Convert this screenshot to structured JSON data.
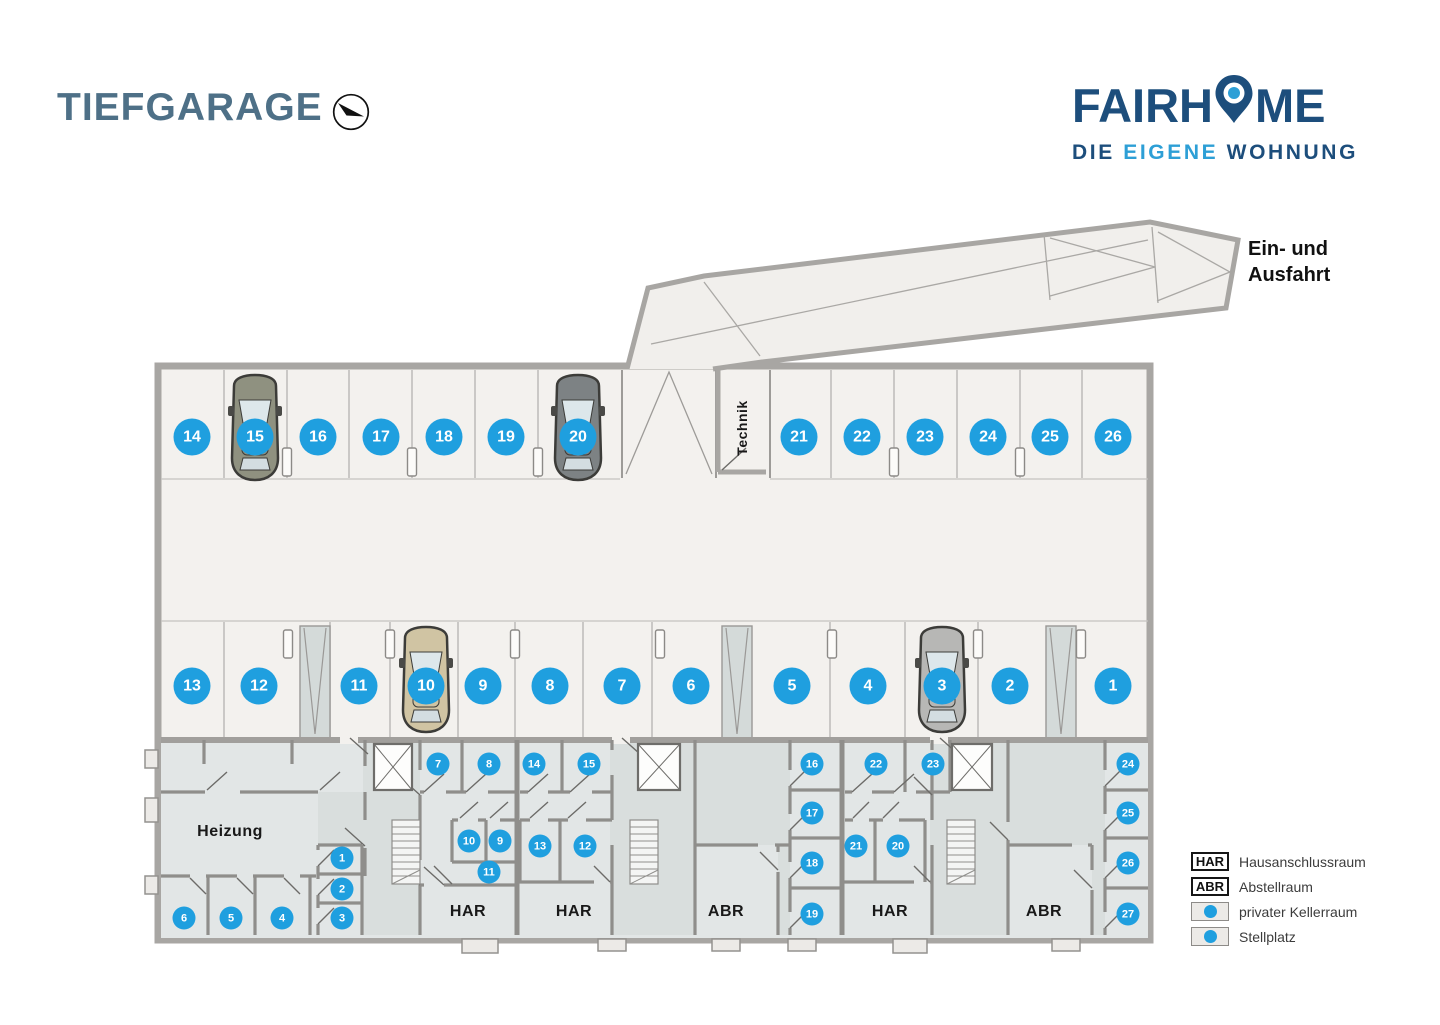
{
  "header": {
    "title": "TIEFGARAGE",
    "logo": {
      "part1": "FAIRH",
      "part2": "ME",
      "tagline_1": "DIE",
      "tagline_2": "EIGENE",
      "tagline_3": "WOHNUNG"
    }
  },
  "plan": {
    "labels": {
      "entrance_line1": "Ein- und",
      "entrance_line2": "Ausfahrt",
      "technik": "Technik",
      "heizung": "Heizung",
      "har": "HAR",
      "abr": "ABR"
    },
    "parking_spots": [
      {
        "n": "14",
        "x": 192,
        "y": 437
      },
      {
        "n": "15",
        "x": 255,
        "y": 437
      },
      {
        "n": "16",
        "x": 318,
        "y": 437
      },
      {
        "n": "17",
        "x": 381,
        "y": 437
      },
      {
        "n": "18",
        "x": 444,
        "y": 437
      },
      {
        "n": "19",
        "x": 506,
        "y": 437
      },
      {
        "n": "20",
        "x": 578,
        "y": 437
      },
      {
        "n": "21",
        "x": 799,
        "y": 437
      },
      {
        "n": "22",
        "x": 862,
        "y": 437
      },
      {
        "n": "23",
        "x": 925,
        "y": 437
      },
      {
        "n": "24",
        "x": 988,
        "y": 437
      },
      {
        "n": "25",
        "x": 1050,
        "y": 437
      },
      {
        "n": "26",
        "x": 1113,
        "y": 437
      },
      {
        "n": "13",
        "x": 192,
        "y": 686
      },
      {
        "n": "12",
        "x": 259,
        "y": 686
      },
      {
        "n": "11",
        "x": 359,
        "y": 686
      },
      {
        "n": "10",
        "x": 426,
        "y": 686
      },
      {
        "n": "9",
        "x": 483,
        "y": 686
      },
      {
        "n": "8",
        "x": 550,
        "y": 686
      },
      {
        "n": "7",
        "x": 622,
        "y": 686
      },
      {
        "n": "6",
        "x": 691,
        "y": 686
      },
      {
        "n": "5",
        "x": 792,
        "y": 686
      },
      {
        "n": "4",
        "x": 868,
        "y": 686
      },
      {
        "n": "3",
        "x": 942,
        "y": 686
      },
      {
        "n": "2",
        "x": 1010,
        "y": 686
      },
      {
        "n": "1",
        "x": 1113,
        "y": 686
      }
    ],
    "cellar_rooms": [
      {
        "n": "1",
        "x": 342,
        "y": 858
      },
      {
        "n": "2",
        "x": 342,
        "y": 889
      },
      {
        "n": "3",
        "x": 342,
        "y": 918
      },
      {
        "n": "4",
        "x": 282,
        "y": 918
      },
      {
        "n": "5",
        "x": 231,
        "y": 918
      },
      {
        "n": "6",
        "x": 184,
        "y": 918
      },
      {
        "n": "7",
        "x": 438,
        "y": 764
      },
      {
        "n": "8",
        "x": 489,
        "y": 764
      },
      {
        "n": "9",
        "x": 500,
        "y": 841
      },
      {
        "n": "10",
        "x": 469,
        "y": 841
      },
      {
        "n": "11",
        "x": 489,
        "y": 872
      },
      {
        "n": "12",
        "x": 585,
        "y": 846
      },
      {
        "n": "13",
        "x": 540,
        "y": 846
      },
      {
        "n": "14",
        "x": 534,
        "y": 764
      },
      {
        "n": "15",
        "x": 589,
        "y": 764
      },
      {
        "n": "16",
        "x": 812,
        "y": 764
      },
      {
        "n": "17",
        "x": 812,
        "y": 813
      },
      {
        "n": "18",
        "x": 812,
        "y": 863
      },
      {
        "n": "19",
        "x": 812,
        "y": 914
      },
      {
        "n": "20",
        "x": 898,
        "y": 846
      },
      {
        "n": "21",
        "x": 856,
        "y": 846
      },
      {
        "n": "22",
        "x": 876,
        "y": 764
      },
      {
        "n": "23",
        "x": 933,
        "y": 764
      },
      {
        "n": "24",
        "x": 1128,
        "y": 764
      },
      {
        "n": "25",
        "x": 1128,
        "y": 813
      },
      {
        "n": "26",
        "x": 1128,
        "y": 863
      },
      {
        "n": "27",
        "x": 1128,
        "y": 914
      }
    ],
    "cars": [
      {
        "spot": "15",
        "x": 255,
        "y": 430,
        "color": "#8f9180"
      },
      {
        "spot": "20",
        "x": 578,
        "y": 430,
        "color": "#7d8284"
      },
      {
        "spot": "10",
        "x": 426,
        "y": 682,
        "color": "#d0c4a3"
      },
      {
        "spot": "3",
        "x": 942,
        "y": 682,
        "color": "#b7b7b5"
      }
    ]
  },
  "legend": {
    "items": [
      {
        "symbol": "HAR",
        "type": "text",
        "label": "Hausanschlussraum"
      },
      {
        "symbol": "ABR",
        "type": "text",
        "label": "Abstellraum"
      },
      {
        "symbol": "",
        "type": "dot",
        "label": "privater Kellerraum"
      },
      {
        "symbol": "",
        "type": "dot",
        "label": "Stellplatz"
      }
    ]
  },
  "colors": {
    "accent": "#1f9fdf",
    "title": "#4e7087",
    "logo_dark": "#1d4e7c",
    "logo_light": "#2d9fd6",
    "floor": "#f3f1ee",
    "basement_floor": "#e2e6e6",
    "wall": "#a8a6a3"
  }
}
